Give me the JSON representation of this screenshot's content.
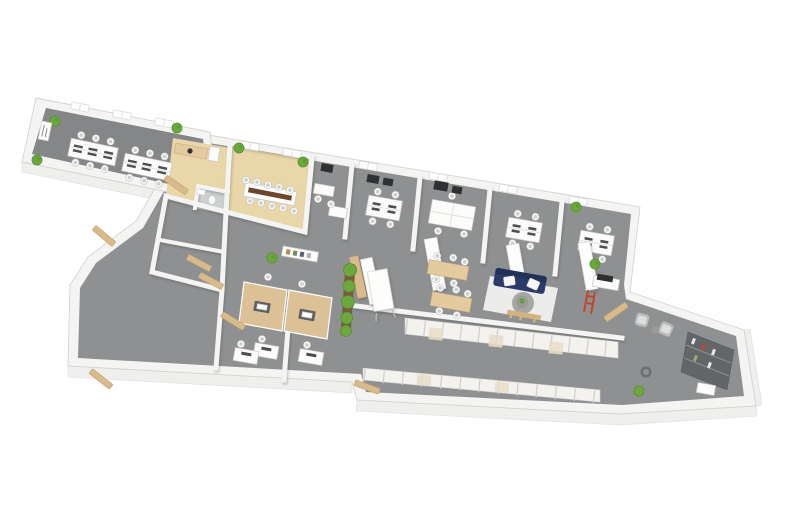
{
  "scene": {
    "type": "isometric-3d-office-floor-plan-rendering",
    "background": "white",
    "areas": [
      {
        "name": "open-office-left-wing",
        "floor": "gray-carpet",
        "items": [
          "two six-person desk benches with monitors and white chairs",
          "three corner plants",
          "dark wall board"
        ]
      },
      {
        "name": "conference-room",
        "floor": "light-wood",
        "items": [
          "ten-seat boardroom table with dark wood runner",
          "two potted plants"
        ]
      },
      {
        "name": "kitchenette",
        "floor": "light-wood",
        "items": [
          "wood worktop with dark cooktop",
          "tall white fridge"
        ]
      },
      {
        "name": "restrooms",
        "floor": "light-tile",
        "items": [
          "toilet",
          "sink",
          "wood doors"
        ]
      },
      {
        "name": "private-office-1",
        "floor": "gray-carpet",
        "items": [
          "two wall desks",
          "two chairs",
          "dark wall art"
        ]
      },
      {
        "name": "private-office-2",
        "floor": "gray-carpet",
        "items": [
          "four-desk cluster",
          "dark wall art"
        ]
      },
      {
        "name": "executive-office",
        "floor": "gray-carpet",
        "items": [
          "large white desk group",
          "three chairs",
          "dark wall art"
        ]
      },
      {
        "name": "private-office-3",
        "floor": "gray-carpet",
        "items": [
          "four-desk cluster"
        ]
      },
      {
        "name": "private-office-4",
        "floor": "gray-carpet",
        "items": [
          "four-desk cluster",
          "corner plant"
        ]
      },
      {
        "name": "open-workspace",
        "floor": "gray-carpet",
        "items": [
          "two wood acoustic meeting booths",
          "four focus desks with chairs",
          "vertical plant tower",
          "mobile whiteboard easel",
          "freestanding divider screens",
          "white wall shelf with books"
        ]
      },
      {
        "name": "cafe-area",
        "floor": "gray-carpet",
        "items": [
          "two wood tables",
          "ten white chairs"
        ]
      },
      {
        "name": "lounge",
        "floor": "gray-carpet",
        "items": [
          "navy sofa with two white pillows",
          "white rug",
          "round gray rug",
          "round coffee table with plant",
          "wood bench",
          "media unit with TV",
          "red ladder shelf"
        ]
      },
      {
        "name": "locker-corridor",
        "floor": "gray-carpet",
        "items": [
          "two long rows of white lockers",
          "wood door"
        ]
      },
      {
        "name": "phone-rooms",
        "floor": "gray-carpet",
        "items": [
          "two single desks with monitors and chairs",
          "wood doors"
        ]
      },
      {
        "name": "reading-lounge-right-wing",
        "floor": "gray-carpet",
        "items": [
          "two gray armchairs",
          "round side table",
          "dark bookshelf wall",
          "dark office chair",
          "green beanbag",
          "white printer cabinet",
          "wood door"
        ]
      }
    ],
    "counts": {
      "meeting_booths": 2,
      "private_offices": 5,
      "desk_benches": 2,
      "cafe_tables": 2,
      "locker_rows": 2,
      "plants": 12,
      "wood_doors": 8,
      "window_openings": 9
    }
  },
  "colors": {
    "background": "#ffffff",
    "floor_gray": "#8e9091",
    "floor_gray_dark": "#848687",
    "wood_floor": "#e9d7a9",
    "tile_light": "#cdd0d1",
    "wall_white": "#f4f4f2",
    "wall_edge": "#d3d3d1",
    "wall_band": "#efefed",
    "door_wood": "#d9ba8c",
    "booth_wood": "#dcc096",
    "plant_green": "#6da83e",
    "plant_dark": "#55902e",
    "sofa_navy": "#2b3a69",
    "rug_light": "#ececea",
    "rug_round": "#a6a6a4",
    "chair_white": "#fbfbfa",
    "chair_gray": "#cdcfd0",
    "desk_white": "#fcfcfb",
    "desk_edge": "#c8c8c6",
    "table_wood": "#e3cb9f",
    "runner_brown": "#6e4630",
    "monitor_dark": "#4c4f51",
    "accent_red": "#c0452f",
    "shelf_dark": "#636668",
    "locker_white": "#f3f2ef",
    "locker_sep": "#cfcecb",
    "locker_tan": "#e7ddc7",
    "art_dark": "#2e3032",
    "bench_wood": "#d3b282",
    "metal_gray": "#9a9a98"
  }
}
